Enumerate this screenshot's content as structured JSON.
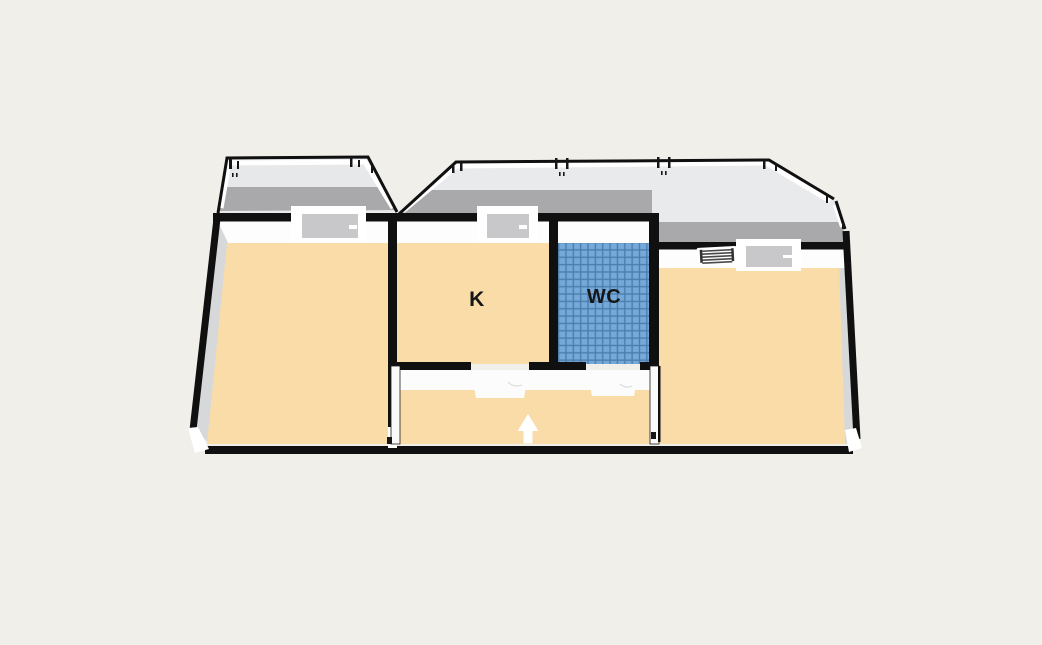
{
  "plan": {
    "type": "floorplan-3d",
    "rooms": {
      "kitchen": {
        "label": "K"
      },
      "wc": {
        "label": "WC"
      },
      "living_left": {
        "label": ""
      },
      "living_right": {
        "label": ""
      },
      "hallway": {
        "label": ""
      }
    },
    "entrance": {
      "arrow_direction": "up"
    },
    "features": [
      "left-balcony",
      "main-balcony",
      "balcony-railings",
      "left-room-window",
      "kitchen-window",
      "right-room-window",
      "radiator",
      "kitchen-door-opening",
      "wc-door-opening"
    ]
  },
  "colors": {
    "background": "#f1efe9",
    "floor": "#f9dca7",
    "tile": "#74a9da",
    "tile_grid": "#4c7dab",
    "wall": "#101010",
    "wall_face": "#fdfdfd",
    "balcony_floor": "#e9eaec",
    "balcony_floor_left": "#e7e8ea",
    "balcony_shadow": "#a9a9ab",
    "glass": "#c8c8ca",
    "arrow": "#ffffff"
  }
}
